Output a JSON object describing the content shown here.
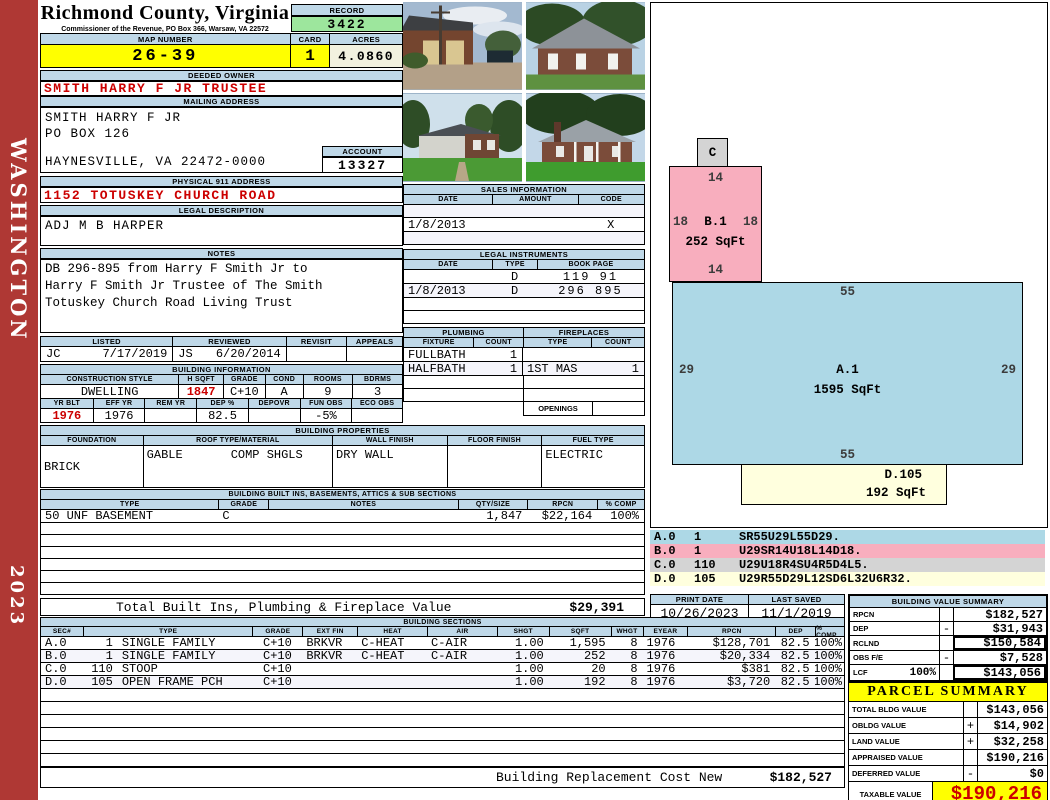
{
  "sidebar": {
    "district": "WASHINGTON",
    "year": "2023"
  },
  "header": {
    "title": "Richmond County, Virginia",
    "subtitle": "Commissioner of the Revenue, PO Box 366, Warsaw, VA 22572",
    "record_label": "RECORD",
    "record_value": "3422",
    "map_number_label": "MAP NUMBER",
    "map_number": "26-39",
    "card_label": "CARD",
    "card": "1",
    "acres_label": "ACRES",
    "acres": "4.0860"
  },
  "owner": {
    "deeded_owner_label": "DEEDED OWNER",
    "deeded_owner": "SMITH HARRY F JR TRUSTEE",
    "mailing_address_label": "MAILING ADDRESS",
    "mailing_line1": "SMITH HARRY F JR",
    "mailing_line2": "PO BOX 126",
    "mailing_line3": "HAYNESVILLE, VA 22472-0000",
    "account_label": "ACCOUNT",
    "account": "13327",
    "physical_address_label": "PHYSICAL 911 ADDRESS",
    "physical_address": "1152 TOTUSKEY CHURCH ROAD",
    "legal_description_label": "LEGAL DESCRIPTION",
    "legal_description": "ADJ M B HARPER"
  },
  "notes": {
    "label": "NOTES",
    "line1": "DB 296-895 from Harry F Smith Jr to",
    "line2": "Harry F Smith Jr Trustee of The Smith",
    "line3": "Totuskey Church Road Living Trust"
  },
  "review": {
    "listed_label": "LISTED",
    "listed_initials": "JC",
    "listed_date": "7/17/2019",
    "reviewed_label": "REVIEWED",
    "reviewed_initials": "JS",
    "reviewed_date": "6/20/2014",
    "revisit_label": "REVISIT",
    "appeals_label": "APPEALS"
  },
  "building_info": {
    "label": "BUILDING INFORMATION",
    "cols1": {
      "style": "CONSTRUCTION STYLE",
      "hsqft": "H SQFT",
      "grade": "GRADE",
      "cond": "COND",
      "rooms": "ROOMS",
      "bdrms": "BDRMS"
    },
    "vals1": {
      "style": "DWELLING",
      "hsqft": "1847",
      "grade": "C+10",
      "cond": "A",
      "rooms": "9",
      "bdrms": "3"
    },
    "cols2": {
      "yrblt": "YR BLT",
      "effyr": "EFF YR",
      "remyr": "REM YR",
      "dep": "DEP %",
      "depovr": "DEPOVR",
      "funobs": "FUN OBS",
      "ecoobs": "ECO OBS"
    },
    "vals2": {
      "yrblt": "1976",
      "effyr": "1976",
      "remyr": "",
      "dep": "82.5",
      "depovr": "",
      "funobs": "-5%",
      "ecoobs": ""
    }
  },
  "building_properties": {
    "label": "BUILDING PROPERTIES",
    "cols": {
      "foundation": "FOUNDATION",
      "roof": "ROOF TYPE/MATERIAL",
      "wall": "WALL FINISH",
      "floor": "FLOOR FINISH",
      "fuel": "FUEL TYPE"
    },
    "vals": {
      "foundation": "BRICK",
      "roof_type": "GABLE",
      "roof_material": "COMP SHGLS",
      "wall": "DRY WALL",
      "floor": "",
      "fuel": "ELECTRIC"
    }
  },
  "built_ins": {
    "label": "BUILDING BUILT INS, BASEMENTS, ATTICS & SUB SECTIONS",
    "cols": {
      "type": "TYPE",
      "grade": "GRADE",
      "notes": "NOTES",
      "qty": "QTY/SIZE",
      "rpcn": "RPCN",
      "comp": "% COMP"
    },
    "rows": [
      {
        "type": "50 UNF BASEMENT",
        "grade": "C",
        "notes": "",
        "qty": "1,847",
        "rpcn": "$22,164",
        "comp": "100%"
      }
    ],
    "total_label": "Total Built Ins, Plumbing & Fireplace Value",
    "total_value": "$29,391"
  },
  "sales": {
    "label": "SALES INFORMATION",
    "cols": {
      "date": "DATE",
      "amount": "AMOUNT",
      "code": "CODE"
    },
    "rows": [
      {
        "date": "",
        "amount": "",
        "code": ""
      },
      {
        "date": "1/8/2013",
        "amount": "",
        "code": "X"
      },
      {
        "date": "",
        "amount": "",
        "code": ""
      }
    ]
  },
  "legal_instruments": {
    "label": "LEGAL INSTRUMENTS",
    "cols": {
      "date": "DATE",
      "type": "TYPE",
      "bookpage": "BOOK PAGE"
    },
    "rows": [
      {
        "date": "",
        "type": "D",
        "bookpage": "119 91"
      },
      {
        "date": "1/8/2013",
        "type": "D",
        "bookpage": "296 895"
      },
      {
        "date": "",
        "type": "",
        "bookpage": ""
      },
      {
        "date": "",
        "type": "",
        "bookpage": ""
      }
    ]
  },
  "plumbing": {
    "label": "PLUMBING",
    "fixture_col": "FIXTURE",
    "count_col": "COUNT",
    "rows": [
      {
        "fixture": "FULLBATH",
        "count": "1"
      },
      {
        "fixture": "HALFBATH",
        "count": "1"
      }
    ]
  },
  "fireplaces": {
    "label": "FIREPLACES",
    "type_col": "TYPE",
    "count_col": "COUNT",
    "rows": [
      {
        "type": "",
        "count": ""
      },
      {
        "type": "1ST MAS",
        "count": "1"
      }
    ],
    "openings_label": "OPENINGS"
  },
  "sketch": {
    "section_c_label": "C",
    "b1": {
      "top": "14",
      "left": "18",
      "name": "B.1",
      "right": "18",
      "sqft": "252 SqFt",
      "bottom": "14"
    },
    "a1": {
      "top": "55",
      "left": "29",
      "name": "A.1",
      "right": "29",
      "sqft": "1595 SqFt",
      "bottom": "55"
    },
    "d105": {
      "name": "D.105",
      "sqft": "192 SqFt"
    }
  },
  "legend": {
    "rows": [
      {
        "sec": "A.0",
        "num": "1",
        "code": "SR55U29L55D29."
      },
      {
        "sec": "B.0",
        "num": "1",
        "code": "U29SR14U18L14D18."
      },
      {
        "sec": "C.0",
        "num": "110",
        "code": "U29U18R4SU4R5D4L5."
      },
      {
        "sec": "D.0",
        "num": "105",
        "code": "U29R55D29L12SD6L32U6R32."
      }
    ]
  },
  "print_info": {
    "print_date_label": "PRINT DATE",
    "print_date": "10/26/2023",
    "last_saved_label": "LAST SAVED",
    "last_saved": "11/1/2019"
  },
  "building_value_summary": {
    "label": "BUILDING VALUE SUMMARY",
    "rows": [
      {
        "label": "RPCN",
        "pct": "",
        "sign": "",
        "value": "$182,527"
      },
      {
        "label": "DEP",
        "pct": "",
        "sign": "-",
        "value": "$31,943"
      },
      {
        "label": "RCLND",
        "pct": "",
        "sign": "",
        "value": "$150,584"
      },
      {
        "label": "OBS F/E",
        "pct": "",
        "sign": "-",
        "value": "$7,528"
      },
      {
        "label": "LCF",
        "pct": "100%",
        "sign": "",
        "value": "$143,056"
      }
    ]
  },
  "building_sections": {
    "label": "BUILDING SECTIONS",
    "cols": {
      "sec": "SEC#",
      "type": "TYPE",
      "grade": "GRADE",
      "extfin": "EXT FIN",
      "heat": "HEAT",
      "air": "AIR",
      "shgt": "SHGT",
      "sqft": "SQFT",
      "whgt": "WHGT",
      "eyear": "EYEAR",
      "rpcn": "RPCN",
      "dep": "DEP",
      "comp": "% COMP"
    },
    "rows": [
      {
        "sec": "A.0",
        "num": "1",
        "type": "SINGLE FAMILY",
        "grade": "C+10",
        "extfin": "BRKVR",
        "heat": "C-HEAT",
        "air": "C-AIR",
        "shgt": "1.00",
        "sqft": "1,595",
        "whgt": "8",
        "eyear": "1976",
        "rpcn": "$128,701",
        "dep": "82.5",
        "comp": "100%"
      },
      {
        "sec": "B.0",
        "num": "1",
        "type": "SINGLE FAMILY",
        "grade": "C+10",
        "extfin": "BRKVR",
        "heat": "C-HEAT",
        "air": "C-AIR",
        "shgt": "1.00",
        "sqft": "252",
        "whgt": "8",
        "eyear": "1976",
        "rpcn": "$20,334",
        "dep": "82.5",
        "comp": "100%"
      },
      {
        "sec": "C.0",
        "num": "110",
        "type": "STOOP",
        "grade": "C+10",
        "extfin": "",
        "heat": "",
        "air": "",
        "shgt": "1.00",
        "sqft": "20",
        "whgt": "8",
        "eyear": "1976",
        "rpcn": "$381",
        "dep": "82.5",
        "comp": "100%"
      },
      {
        "sec": "D.0",
        "num": "105",
        "type": "OPEN FRAME PCH",
        "grade": "C+10",
        "extfin": "",
        "heat": "",
        "air": "",
        "shgt": "1.00",
        "sqft": "192",
        "whgt": "8",
        "eyear": "1976",
        "rpcn": "$3,720",
        "dep": "82.5",
        "comp": "100%"
      }
    ],
    "footer_label": "Building Replacement Cost New",
    "footer_value": "$182,527"
  },
  "parcel_summary": {
    "label": "PARCEL SUMMARY",
    "rows": [
      {
        "label": "TOTAL BLDG VALUE",
        "sign": "",
        "value": "$143,056"
      },
      {
        "label": "OBLDG VALUE",
        "sign": "+",
        "value": "$14,902"
      },
      {
        "label": "LAND VALUE",
        "sign": "+",
        "value": "$32,258"
      },
      {
        "label": "APPRAISED VALUE",
        "sign": "",
        "value": "$190,216"
      },
      {
        "label": "DEFERRED VALUE",
        "sign": "-",
        "value": "$0"
      }
    ],
    "taxable_label": "TAXABLE VALUE",
    "taxable_value": "$190,216"
  },
  "colors": {
    "sidebar_red": "#AF3834",
    "header_blue": "#BFD8E8",
    "highlight_yellow": "#FFFF00",
    "record_green": "#9DE69D",
    "acres_cream": "#F2F1DF",
    "alert_red": "#CC0000",
    "sketch_blue": "#ADD8E6",
    "sketch_pink": "#F8AEBE",
    "sketch_gray": "#D4D4D4",
    "sketch_yellow": "#FFFFDE"
  }
}
